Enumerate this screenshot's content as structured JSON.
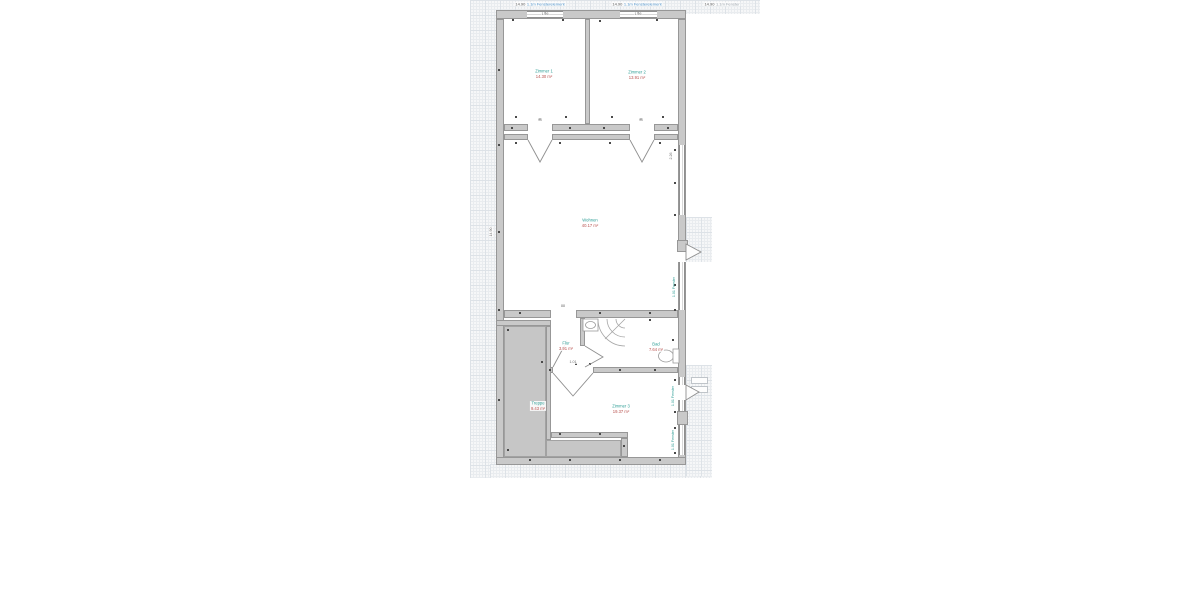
{
  "meta": {
    "drawing_type": "floor-plan",
    "background": "#ffffff"
  },
  "colors": {
    "wall_fill": "#c9c9c9",
    "wall_edge": "#979797",
    "window_line": "#b0b0b0",
    "grid_bg": "#f6f7f8",
    "grid_minor": "#e9ecef",
    "grid_major": "#dde2e7",
    "gray_area": "#c6c6c6",
    "room_name": "#2e9e96",
    "room_area": "#b8514e",
    "annotation_text": "#5a5a5a",
    "annotation_link": "#4a90c8",
    "annotation_muted": "#9aa3ab",
    "micro_text": "#6f6f6f",
    "tick": "#4a4a4a",
    "swing": "#8f8f8f"
  },
  "annotations": [
    {
      "cx": 540,
      "cy": 4,
      "prefix": "14.90",
      "label": "1.1m Fensterelement",
      "style": "link"
    },
    {
      "cx": 637,
      "cy": 4,
      "prefix": "14.90",
      "label": "1.1m Fensterelement",
      "style": "link"
    },
    {
      "cx": 722,
      "cy": 4,
      "prefix": "14.90",
      "label": "1.1m Fenster",
      "style": "muted"
    }
  ],
  "rooms": [
    {
      "id": "room-top-left",
      "name": "Zimmer 1",
      "area": "14.30 m²",
      "cx": 544,
      "cy": 74
    },
    {
      "id": "room-top-right",
      "name": "Zimmer 2",
      "area": "13.91 m²",
      "cx": 637,
      "cy": 75
    },
    {
      "id": "room-living",
      "name": "Wohnen",
      "area": "40.17 m²",
      "cx": 590,
      "cy": 223
    },
    {
      "id": "room-hall",
      "name": "Flur",
      "area": "3.91 m²",
      "cx": 566,
      "cy": 346
    },
    {
      "id": "room-bath",
      "name": "Bad",
      "area": "7.64 m²",
      "cx": 656,
      "cy": 347
    },
    {
      "id": "room-stairs",
      "name": "Treppe",
      "area": "9.43 m²",
      "cx": 538,
      "cy": 406
    },
    {
      "id": "room-bottom",
      "name": "Zimmer 3",
      "area": "19.37 m²",
      "cx": 621,
      "cy": 409
    }
  ],
  "window_labels": [
    {
      "cx": 674,
      "cy": 287,
      "text": "1.01 Fenster"
    },
    {
      "cx": 673,
      "cy": 396,
      "text": "1.01 Fenster"
    },
    {
      "cx": 673,
      "cy": 440,
      "text": "1.01 Fenster"
    }
  ],
  "micro_labels": [
    {
      "cx": 540,
      "cy": 120,
      "text": "90"
    },
    {
      "cx": 641,
      "cy": 120,
      "text": "90"
    },
    {
      "cx": 545,
      "cy": 14,
      "text": "1.26"
    },
    {
      "cx": 638,
      "cy": 14,
      "text": "1.26"
    },
    {
      "cx": 563,
      "cy": 306,
      "text": "88"
    },
    {
      "cx": 573,
      "cy": 362,
      "text": "1.01"
    },
    {
      "cx": 491,
      "cy": 232,
      "text": "14.90",
      "vertical": true
    },
    {
      "cx": 671,
      "cy": 156,
      "text": "2.26",
      "vertical": true
    }
  ],
  "geometry": {
    "grid_patches": [
      [
        470,
        0,
        290,
        14
      ],
      [
        470,
        0,
        26,
        478
      ],
      [
        490,
        464,
        222,
        14
      ],
      [
        686,
        217,
        26,
        45
      ],
      [
        686,
        365,
        26,
        111
      ]
    ],
    "walls": [
      [
        496,
        10,
        190,
        9
      ],
      [
        496,
        19,
        8,
        446
      ],
      [
        678,
        19,
        8,
        446
      ],
      [
        496,
        457,
        190,
        8
      ],
      [
        585,
        19,
        5,
        105
      ],
      [
        504,
        124,
        24,
        7
      ],
      [
        552,
        124,
        78,
        7
      ],
      [
        654,
        124,
        24,
        7
      ],
      [
        504,
        134,
        24,
        6
      ],
      [
        552,
        134,
        78,
        6
      ],
      [
        654,
        134,
        24,
        6
      ],
      [
        504,
        310,
        47,
        8
      ],
      [
        576,
        310,
        102,
        8
      ],
      [
        580,
        318,
        5,
        28
      ],
      [
        546,
        367,
        7,
        6
      ],
      [
        593,
        367,
        85,
        6
      ],
      [
        496,
        320,
        55,
        6
      ],
      [
        546,
        326,
        5,
        114
      ],
      [
        551,
        432,
        77,
        6
      ],
      [
        621,
        438,
        7,
        19
      ],
      [
        677,
        411,
        11,
        14
      ],
      [
        677,
        240,
        11,
        12
      ]
    ],
    "windows": [
      [
        527,
        11,
        36,
        7
      ],
      [
        620,
        11,
        37,
        7
      ],
      [
        679,
        145,
        6,
        70
      ],
      [
        679,
        262,
        6,
        48
      ],
      [
        679,
        377,
        6,
        34
      ],
      [
        679,
        425,
        6,
        30
      ]
    ],
    "openings": [
      [
        678,
        252,
        8,
        10
      ],
      [
        678,
        385,
        8,
        15
      ]
    ],
    "gray_areas": [
      [
        504,
        326,
        42,
        131
      ],
      [
        546,
        440,
        75,
        17
      ]
    ],
    "steps": [
      [
        691,
        377,
        17,
        7
      ],
      [
        691,
        386,
        17,
        7
      ]
    ],
    "door_swings": [
      {
        "points": [
          [
            528,
            140
          ],
          [
            540,
            162
          ],
          [
            552,
            140
          ]
        ],
        "closed": false
      },
      {
        "points": [
          [
            630,
            140
          ],
          [
            642,
            162
          ],
          [
            654,
            140
          ]
        ],
        "closed": false
      },
      {
        "points": [
          [
            553,
            373
          ],
          [
            573,
            396
          ],
          [
            593,
            373
          ]
        ],
        "closed": false
      },
      {
        "points": [
          [
            553,
            367
          ],
          [
            567,
            341
          ]
        ],
        "closed": false
      },
      {
        "points": [
          [
            585,
            346
          ],
          [
            603,
            357
          ],
          [
            585,
            367
          ]
        ],
        "closed": false
      },
      {
        "points": [
          [
            686,
            244
          ],
          [
            701,
            252
          ],
          [
            686,
            260
          ]
        ],
        "closed": true
      },
      {
        "points": [
          [
            686,
            385
          ],
          [
            699,
            392
          ],
          [
            686,
            400
          ]
        ],
        "closed": true
      }
    ],
    "fixtures": {
      "sink_rect": [
        583,
        319,
        15,
        12
      ],
      "sink_basin": [
        590.5,
        325,
        5,
        3.5
      ],
      "shower_center": [
        625,
        319
      ],
      "shower_radii": [
        27,
        18,
        9
      ],
      "toilet_bowl": [
        666,
        356,
        7.5,
        6
      ],
      "toilet_tank": [
        673,
        349,
        6,
        14
      ]
    },
    "ticks": [
      [
        513,
        20
      ],
      [
        545,
        13
      ],
      [
        563,
        20
      ],
      [
        600,
        21
      ],
      [
        638,
        13
      ],
      [
        657,
        20
      ],
      [
        516,
        117
      ],
      [
        540,
        119
      ],
      [
        566,
        117
      ],
      [
        612,
        117
      ],
      [
        641,
        119
      ],
      [
        663,
        117
      ],
      [
        512,
        128
      ],
      [
        570,
        128
      ],
      [
        604,
        128
      ],
      [
        668,
        128
      ],
      [
        516,
        143
      ],
      [
        560,
        143
      ],
      [
        610,
        143
      ],
      [
        660,
        143
      ],
      [
        499,
        70
      ],
      [
        499,
        145
      ],
      [
        499,
        232
      ],
      [
        499,
        310
      ],
      [
        499,
        400
      ],
      [
        675,
        150
      ],
      [
        675,
        183
      ],
      [
        675,
        215
      ],
      [
        675,
        285
      ],
      [
        675,
        310
      ],
      [
        520,
        313
      ],
      [
        600,
        313
      ],
      [
        650,
        313
      ],
      [
        550,
        370
      ],
      [
        576,
        364
      ],
      [
        620,
        370
      ],
      [
        655,
        370
      ],
      [
        675,
        380
      ],
      [
        675,
        412
      ],
      [
        675,
        428
      ],
      [
        675,
        453
      ],
      [
        560,
        434
      ],
      [
        600,
        434
      ],
      [
        624,
        446
      ],
      [
        508,
        330
      ],
      [
        542,
        362
      ],
      [
        508,
        450
      ],
      [
        530,
        460
      ],
      [
        570,
        460
      ],
      [
        620,
        460
      ],
      [
        660,
        460
      ],
      [
        590,
        364
      ],
      [
        650,
        320
      ],
      [
        673,
        340
      ]
    ]
  }
}
